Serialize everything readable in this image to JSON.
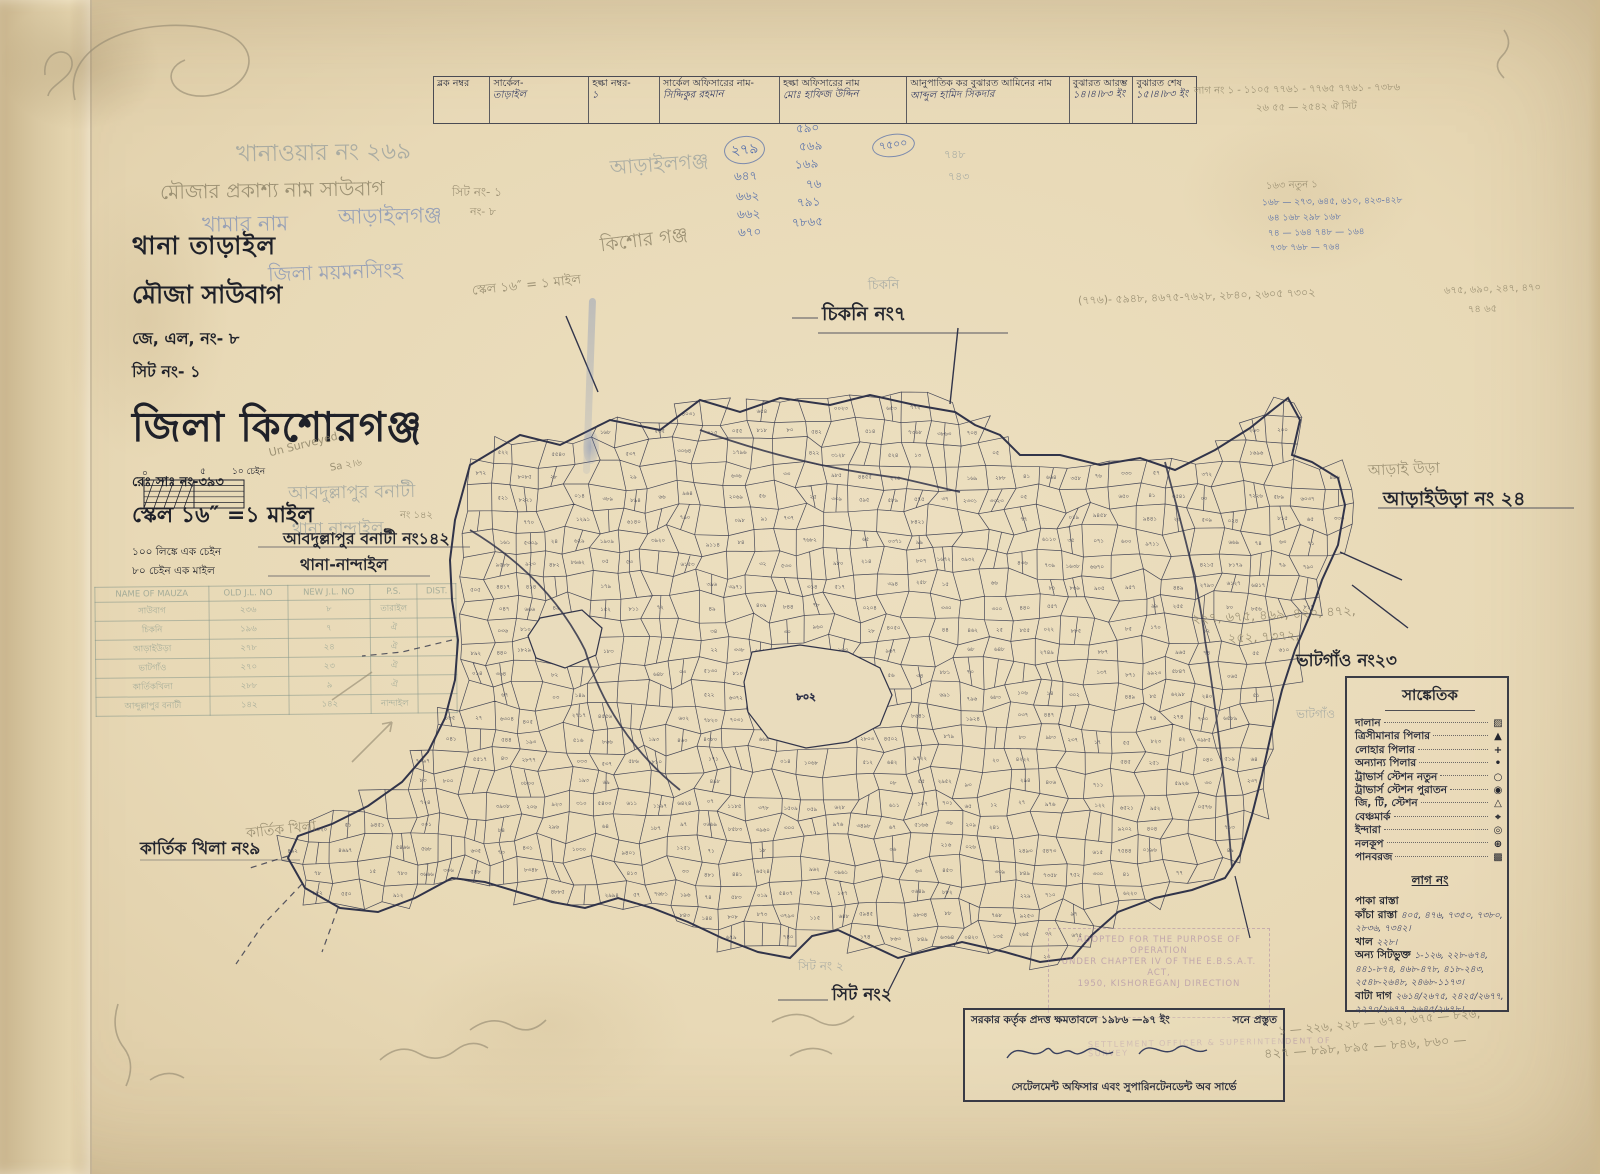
{
  "colors": {
    "paper": "#e8d9b6",
    "ink": "#2e3142",
    "print_ink": "#23252f",
    "blue_hand": "#4260a8",
    "pencil": "#8a7f64",
    "purple_stamp": "#9169a0"
  },
  "header_table": {
    "cells": [
      {
        "label": "ব্লক নম্বর",
        "value": ""
      },
      {
        "label": "সার্কেল-",
        "value": "তাড়াইল"
      },
      {
        "label": "হল্কা নম্বর-",
        "value": "১"
      },
      {
        "label": "সার্কেল অফিসারের নাম-",
        "value": "সিদ্দিকুর রহমান"
      },
      {
        "label": "হল্কা অফিসারের নাম",
        "value": "মোঃ হাফিজ উদ্দিন"
      },
      {
        "label": "আনুপাতিক কর বুঝারত আমিনের নাম",
        "value": "আব্দুল হামিদ সিকদার"
      },
      {
        "label": "বুঝারত আরম্ভ",
        "value": "১৪।৪।৮৩ ইং"
      },
      {
        "label": "বুঝারত শেষ",
        "value": "১৫।৪।৮৩ ইং"
      }
    ]
  },
  "title_block": {
    "thana": "থানা তাড়াইল",
    "mouza": "মৌজা সাউবাগ",
    "jl_no": "জে, এল, নং- ৮",
    "sheet_no": "সিট নং- ১",
    "district": "জিলা কিশোরগঞ্জ",
    "reg_no": "রেঃ সাঃ নং-৩৯৩",
    "scale": "স্কেল ১৬″ =১ মাইল",
    "note1": "১০০ লিঙ্কে এক চেইন",
    "note2": "৮০ চেইন এক মাইল"
  },
  "scale_bar": {
    "zero": "০",
    "five": "৫",
    "ten": "১০ চেইন"
  },
  "neighbors": [
    {
      "text": "চিকনি নং৭"
    },
    {
      "text": "আড়াইউড়া নং ২৪"
    },
    {
      "text": "ভাটগাঁও নং২৩"
    },
    {
      "text": "কার্তিক খিলা নং৯"
    },
    {
      "text": "সিট নং২"
    },
    {
      "text": "আবদুল্লাপুর বনাটী নং১৪২"
    },
    {
      "text": "থানা-নান্দাইল"
    }
  ],
  "legend": {
    "title": "সাঙ্কেতিক",
    "items": [
      {
        "label": "দালান",
        "symbol": "▨"
      },
      {
        "label": "ত্রিসীমানার পিলার",
        "symbol": "▲"
      },
      {
        "label": "লোহার পিলার",
        "symbol": "+"
      },
      {
        "label": "অন্যান্য পিলার",
        "symbol": "•"
      },
      {
        "label": "ট্রাভার্স স্টেশন নতুন",
        "symbol": "○"
      },
      {
        "label": "ট্রাভার্স স্টেশন পুরাতন",
        "symbol": "◉"
      },
      {
        "label": "জি, টি, স্টেশন",
        "symbol": "△"
      },
      {
        "label": "বেঞ্চমার্ক",
        "symbol": "⌖"
      },
      {
        "label": "ইন্দারা",
        "symbol": "◎"
      },
      {
        "label": "নলকূপ",
        "symbol": "⊕"
      },
      {
        "label": "পানবরজ",
        "symbol": "▩"
      }
    ],
    "lag_title": "লাগ নং",
    "lag_items": [
      {
        "label": "পাকা রাস্তা",
        "value": ""
      },
      {
        "label": "কাঁচা রাস্তা",
        "value": "৪০৫, ৪৭৬, ৭৩৫০, ৭৩৮০, ২৮৩৬, ৭৩৪২।"
      },
      {
        "label": "খাল",
        "value": "২২৮।"
      },
      {
        "label": "অন্য সিটভুক্ত",
        "value": "১-১২৬, ২২৮-৬৭৪, ৪৪১-৮৭৪, ৪৬৮-৪৭৮, ৪১৮-২৪৩, ২৫৪৮-২৬৪৮, ২৪৬৮-১১৭৩।"
      },
      {
        "label": "বাটা দাগ",
        "value": "২৬১৪/২৬৭৫, ২৪২৫/২৬৭৭, ২২৭০/২৬৭৭, ২৬৪৫/২৬৭৮।"
      }
    ]
  },
  "stamp_box": {
    "line1": "সরকার কর্তৃক প্রদত্ত ক্ষমতাবলে ১৯৮৬ —৯৭ ইং",
    "line1_right": "সনে প্রস্তুত",
    "line2": "সেটেলমেন্ট অফিসার এবং সুপারিনটেনডেন্ট অব সার্ভে"
  },
  "stamps": {
    "purple_box_lines": [
      "ADOPTED FOR THE PURPOSE OF OPERATION",
      "UNDER CHAPTER IV OF THE E.B.S.A.T. ACT,",
      "1950, KISHOREGANJ DIRECTION"
    ],
    "purple_line": "SETTLEMENT OFFICER & SUPERINTENDENT OF SURVEY"
  },
  "mauza_table": {
    "headers": [
      "NAME OF MAUZA",
      "OLD J.L. NO",
      "NEW J.L. NO",
      "P.S.",
      "DIST."
    ],
    "rows": [
      [
        "সাউবাগ",
        "২৩৬",
        "৮",
        "তারাইল",
        ""
      ],
      [
        "চিকনি",
        "১৯৬",
        "৭",
        "ঐ",
        ""
      ],
      [
        "আড়াইউড়া",
        "২৭৮",
        "২৪",
        "ঐ",
        ""
      ],
      [
        "ভাটগাঁও",
        "২৭০",
        "২৩",
        "ঐ",
        ""
      ],
      [
        "কার্তিকখিলা",
        "২৮৮",
        "৯",
        "ঐ",
        ""
      ],
      [
        "আব্দুল্লাপুর বনাটী",
        "১৪২",
        "১৪২",
        "নান্দাইল",
        ""
      ]
    ]
  },
  "map": {
    "parcel_digits": "০১২৩৪৫৬৭৮৯",
    "blank_label": "৮০২",
    "seed": 7
  },
  "notes": [
    {
      "t": "খানাওয়ার নং ২৬৯",
      "x": 236,
      "y": 134,
      "s": 23,
      "c": "g-stamp",
      "r": -1
    },
    {
      "t": "মৌজার প্রকাশ্য নাম সাউবাগ",
      "x": 160,
      "y": 176,
      "s": 20,
      "c": "g-pencil",
      "r": -1
    },
    {
      "t": "সিট নং- ১",
      "x": 452,
      "y": 184,
      "s": 12,
      "c": "g-pencil",
      "r": 0
    },
    {
      "t": "নং- ৮",
      "x": 470,
      "y": 203,
      "s": 11,
      "c": "g-pencil",
      "r": 0
    },
    {
      "t": "খামার নাম",
      "x": 202,
      "y": 208,
      "s": 21,
      "c": "g-blue",
      "r": -1
    },
    {
      "t": "আড়াইলগঞ্জ",
      "x": 338,
      "y": 200,
      "s": 21,
      "c": "g-blue",
      "r": -1
    },
    {
      "t": "আড়াইলগঞ্জ",
      "x": 610,
      "y": 150,
      "s": 20,
      "c": "g-stamp",
      "r": -4
    },
    {
      "t": "কিশোর গঞ্জ",
      "x": 600,
      "y": 226,
      "s": 19,
      "c": "g-pencil",
      "r": -7
    },
    {
      "t": "জিলা ময়মনসিংহ",
      "x": 268,
      "y": 258,
      "s": 20,
      "c": "g-blue",
      "r": -2
    },
    {
      "t": "স্কেল ১৬″ = ১ মাইল",
      "x": 472,
      "y": 276,
      "s": 13,
      "c": "g-pencil",
      "r": -6
    },
    {
      "t": "Un Surveyed",
      "x": 268,
      "y": 438,
      "s": 11,
      "c": "g-pencil",
      "r": -14
    },
    {
      "t": "Sa ২।৬",
      "x": 330,
      "y": 458,
      "s": 10,
      "c": "g-pencil",
      "r": -10
    },
    {
      "t": "আবদুল্লাপুর বনাটী",
      "x": 288,
      "y": 478,
      "s": 18,
      "c": "g-stamp",
      "r": -1
    },
    {
      "t": "নং ১৪২",
      "x": 400,
      "y": 508,
      "s": 10,
      "c": "g-pencil",
      "r": 0
    },
    {
      "t": "থানা নান্দাইল",
      "x": 292,
      "y": 516,
      "s": 17,
      "c": "g-stamp",
      "r": -1
    },
    {
      "t": "কার্তিক খিলা",
      "x": 246,
      "y": 818,
      "s": 14,
      "c": "g-pencil",
      "r": -6
    },
    {
      "t": "আড়াই উড়া",
      "x": 1368,
      "y": 458,
      "s": 15,
      "c": "g-pencil",
      "r": -2
    },
    {
      "t": "ভাটগাঁও",
      "x": 1296,
      "y": 706,
      "s": 12,
      "c": "g-stamp",
      "r": 0
    },
    {
      "t": "চিকনি",
      "x": 868,
      "y": 276,
      "s": 13,
      "c": "g-stamp",
      "r": -2
    },
    {
      "t": "২৭৯",
      "x": 724,
      "y": 136,
      "s": 14,
      "c": "n-blue-circ",
      "r": -6
    },
    {
      "t": "৭৫০০",
      "x": 872,
      "y": 134,
      "s": 11,
      "c": "n-blue-circ",
      "r": -8
    },
    {
      "t": "৫৯০",
      "x": 796,
      "y": 120,
      "s": 12,
      "c": "n-blue",
      "r": -3
    },
    {
      "t": "৫৬৯",
      "x": 799,
      "y": 138,
      "s": 12,
      "c": "n-blue",
      "r": -3
    },
    {
      "t": "১৬৯",
      "x": 795,
      "y": 156,
      "s": 12,
      "c": "n-blue",
      "r": -3
    },
    {
      "t": "৭৬",
      "x": 806,
      "y": 176,
      "s": 12,
      "c": "n-blue",
      "r": -3
    },
    {
      "t": "৭৯১",
      "x": 797,
      "y": 194,
      "s": 12,
      "c": "n-blue",
      "r": -3
    },
    {
      "t": "৭৮৬৫",
      "x": 792,
      "y": 214,
      "s": 12,
      "c": "n-blue",
      "r": -3
    },
    {
      "t": "৬৪৭",
      "x": 734,
      "y": 168,
      "s": 12,
      "c": "n-blue",
      "r": -2
    },
    {
      "t": "৬৬২",
      "x": 736,
      "y": 188,
      "s": 12,
      "c": "n-blue",
      "r": -2
    },
    {
      "t": "৬৬২",
      "x": 737,
      "y": 206,
      "s": 12,
      "c": "n-blue",
      "r": -2
    },
    {
      "t": "৬৭০",
      "x": 738,
      "y": 224,
      "s": 12,
      "c": "n-blue",
      "r": -2
    },
    {
      "t": "৭৪৮",
      "x": 944,
      "y": 146,
      "s": 11,
      "c": "g-stamp",
      "r": 0
    },
    {
      "t": "৭৪৩",
      "x": 948,
      "y": 168,
      "s": 11,
      "c": "g-stamp",
      "r": 0
    },
    {
      "t": "১৬৩ নতুন ১",
      "x": 1266,
      "y": 178,
      "s": 10,
      "c": "g-pencil",
      "r": -2
    },
    {
      "t": "১৬৮ — ২৭৩, ৬৪৫, ৬১০, ৪২৩-৪২৮",
      "x": 1262,
      "y": 194,
      "s": 9,
      "c": "n-blue",
      "r": -1
    },
    {
      "t": "৬৪ ১৬৮ ২৯৮ ১৬৮",
      "x": 1268,
      "y": 210,
      "s": 9,
      "c": "n-blue",
      "r": -1
    },
    {
      "t": "৭৪ — ১৬৪ ৭৪৮ — ১৬৪",
      "x": 1268,
      "y": 225,
      "s": 9,
      "c": "n-blue",
      "r": -1
    },
    {
      "t": "৭৩৮ ৭৬৮ — ৭৬৪",
      "x": 1270,
      "y": 240,
      "s": 9,
      "c": "n-blue",
      "r": -1
    },
    {
      "t": "লাগ নং ১ - ১১০৫ ৭৭৬১ - ৭৭৬৫ ৭৭৬১ - ৭৩৮৬",
      "x": 1194,
      "y": 82,
      "s": 10,
      "c": "g-pencil",
      "r": -1
    },
    {
      "t": "২৬ ৫৫ — ২৫৪২ ঐ সিট",
      "x": 1256,
      "y": 100,
      "s": 10,
      "c": "g-pencil",
      "r": -1
    },
    {
      "t": "(৭৭৬)- ৫৯৪৮, ৪৬৭৫-৭৬২৮, ২৮৪০, ২৬০৫ ৭৩০২",
      "x": 1078,
      "y": 288,
      "s": 11,
      "c": "g-pencil",
      "r": -2
    },
    {
      "t": "৬৭৫, ৬৯০, ২৪৭, ৪৭০",
      "x": 1444,
      "y": 282,
      "s": 10,
      "c": "g-pencil",
      "r": -2
    },
    {
      "t": "৭৪ ৬৫",
      "x": 1468,
      "y": 302,
      "s": 10,
      "c": "g-pencil",
      "r": -2
    },
    {
      "t": "২২৭, ৬৭৫, ৪৬৯, ৪২০, ৪৭২,",
      "x": 1192,
      "y": 606,
      "s": 13,
      "c": "g-pencil",
      "r": -3
    },
    {
      "t": "২৫২, ৭৩৭২,",
      "x": 1228,
      "y": 628,
      "s": 13,
      "c": "g-pencil",
      "r": -3
    },
    {
      "t": "১ — ২২৬, ২২৮ — ৬৭৪, ৬৭৫ — ৮২৬,",
      "x": 1278,
      "y": 1014,
      "s": 12,
      "c": "g-pencil",
      "r": -5
    },
    {
      "t": "৪২৭ — ৮৯৮, ৮৯৫ — ৮৪৬, ৮৬০ —",
      "x": 1264,
      "y": 1038,
      "s": 13,
      "c": "g-pencil",
      "r": -4
    },
    {
      "t": "সিট নং ২",
      "x": 798,
      "y": 958,
      "s": 12,
      "c": "g-stamp",
      "r": 0
    }
  ]
}
